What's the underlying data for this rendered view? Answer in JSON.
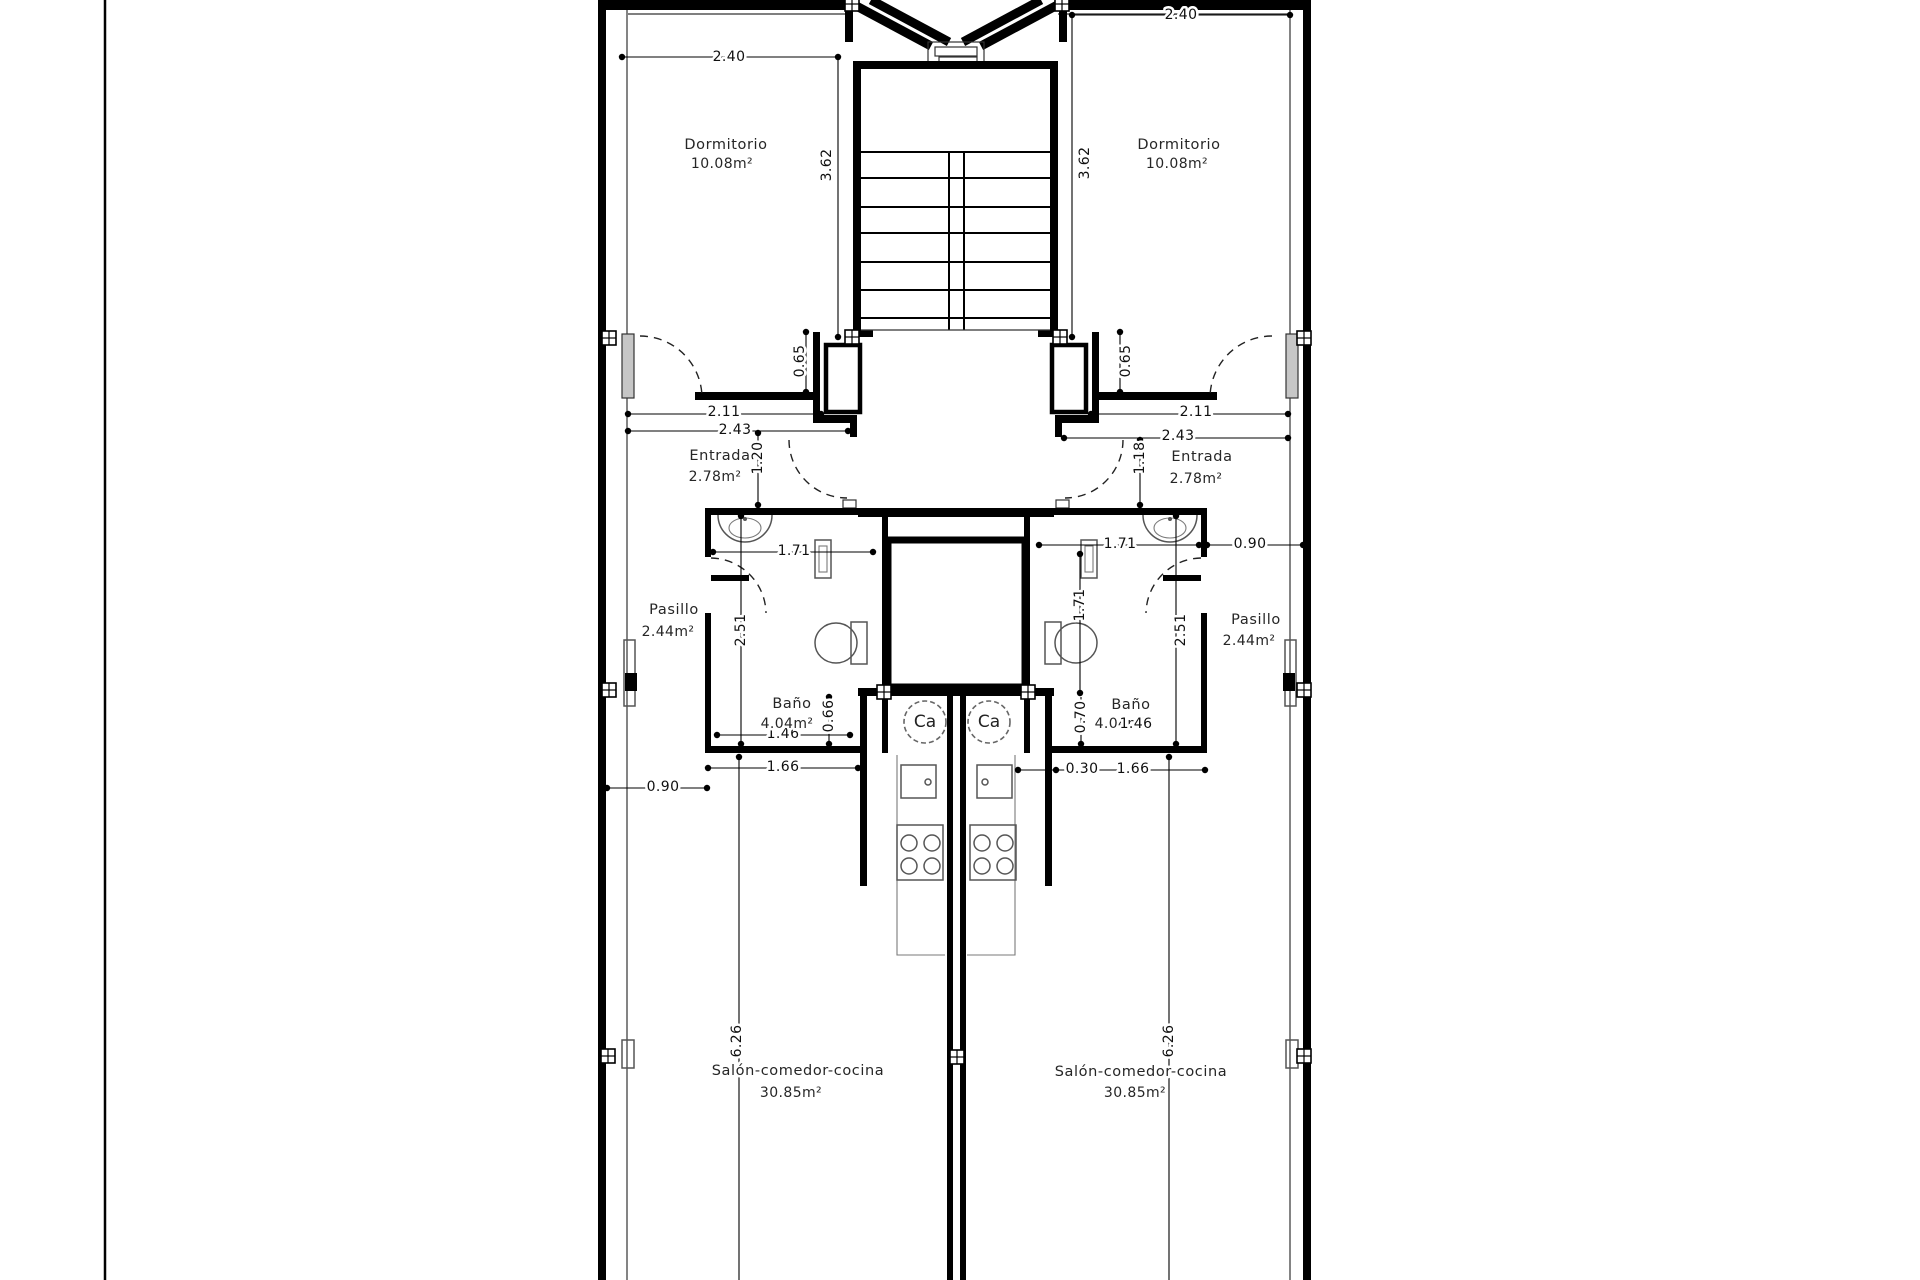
{
  "drawing": {
    "rooms": {
      "dormitorio": {
        "name": "Dormitorio",
        "area": "10.08m²"
      },
      "entrada": {
        "name": "Entrada",
        "area": "2.78m²"
      },
      "pasillo": {
        "name": "Pasillo",
        "area": "2.44m²"
      },
      "bano": {
        "name": "Baño",
        "area": "4.04m²"
      },
      "salon": {
        "name": "Salón-comedor-cocina",
        "area": "30.85m²"
      }
    },
    "dims": {
      "w240": "2.40",
      "h362": "3.62",
      "h065": "0.65",
      "w211": "2.11",
      "w243": "2.43",
      "h120": "1.20",
      "h118": "1.18",
      "w171": "1.71",
      "h171": "1.71",
      "h251": "2.51",
      "h066": "0.66",
      "h070": "0.70",
      "w146": "1.46",
      "w166": "1.66",
      "w090": "0.90",
      "w030": "0.30",
      "h626": "6.26"
    },
    "labels": {
      "heater": "Ca"
    },
    "colors": {
      "wall": "#000000",
      "fixture": "#555555",
      "paper": "#ffffff"
    }
  }
}
